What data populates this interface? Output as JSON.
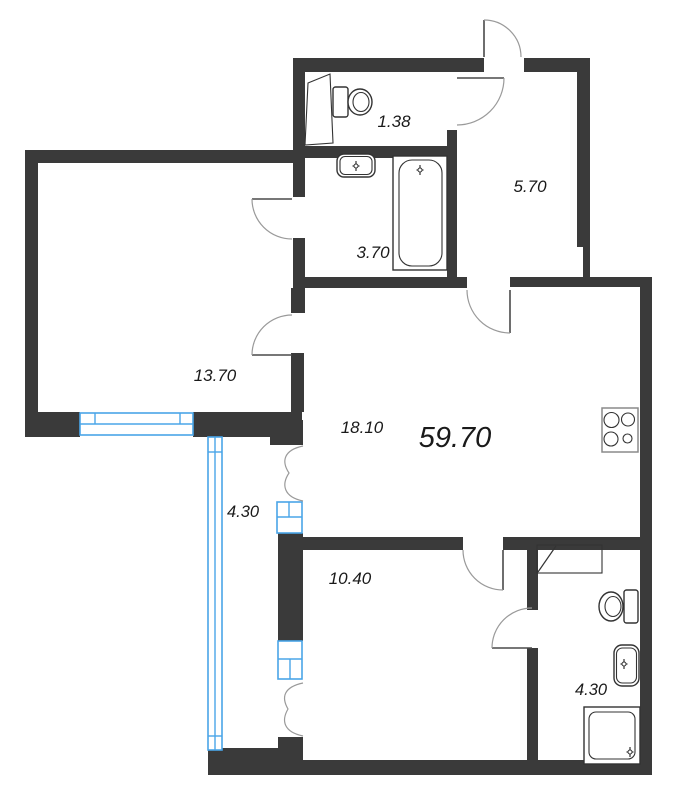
{
  "plan": {
    "type": "apartment-floor-plan",
    "total_area": "59.70",
    "rooms": [
      {
        "name": "wc",
        "area": "1.38"
      },
      {
        "name": "bathroom",
        "area": "3.70"
      },
      {
        "name": "hallway",
        "area": "5.70"
      },
      {
        "name": "room-left",
        "area": "13.70"
      },
      {
        "name": "kitchen-living",
        "area": "18.10"
      },
      {
        "name": "balcony",
        "area": "4.30"
      },
      {
        "name": "room-bottom",
        "area": "10.40"
      },
      {
        "name": "shower-room",
        "area": "4.30"
      }
    ],
    "fixtures": [
      "toilet",
      "counter",
      "sink",
      "bathtub",
      "stove",
      "washer",
      "shower"
    ],
    "colors": {
      "wall": "#3a3a3a",
      "window": "#4aa5e8",
      "door_arc": "#9a9a9a",
      "fixture": "#333333",
      "background": "#ffffff",
      "text": "#1a1a1a"
    }
  }
}
